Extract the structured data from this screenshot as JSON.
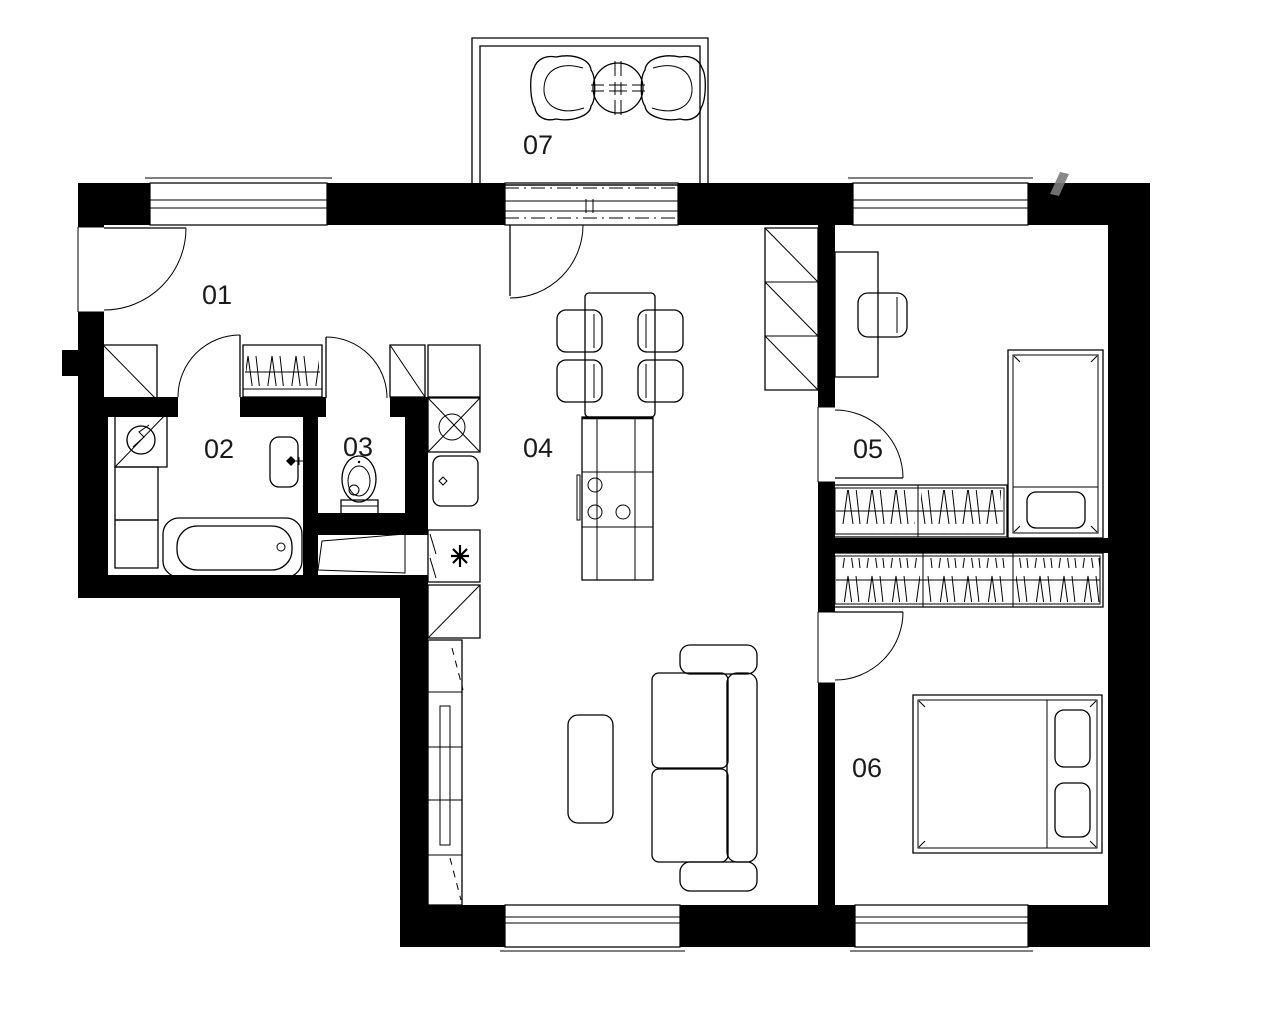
{
  "rooms": [
    {
      "label": "01"
    },
    {
      "label": "02"
    },
    {
      "label": "03"
    },
    {
      "label": "04"
    },
    {
      "label": "05"
    },
    {
      "label": "06"
    },
    {
      "label": "07"
    }
  ],
  "colors": {
    "walls": "#000000",
    "lines": "#000000",
    "background": "#ffffff",
    "room_labels": "#1a1a1a",
    "watermark": "#7a7a7a"
  }
}
